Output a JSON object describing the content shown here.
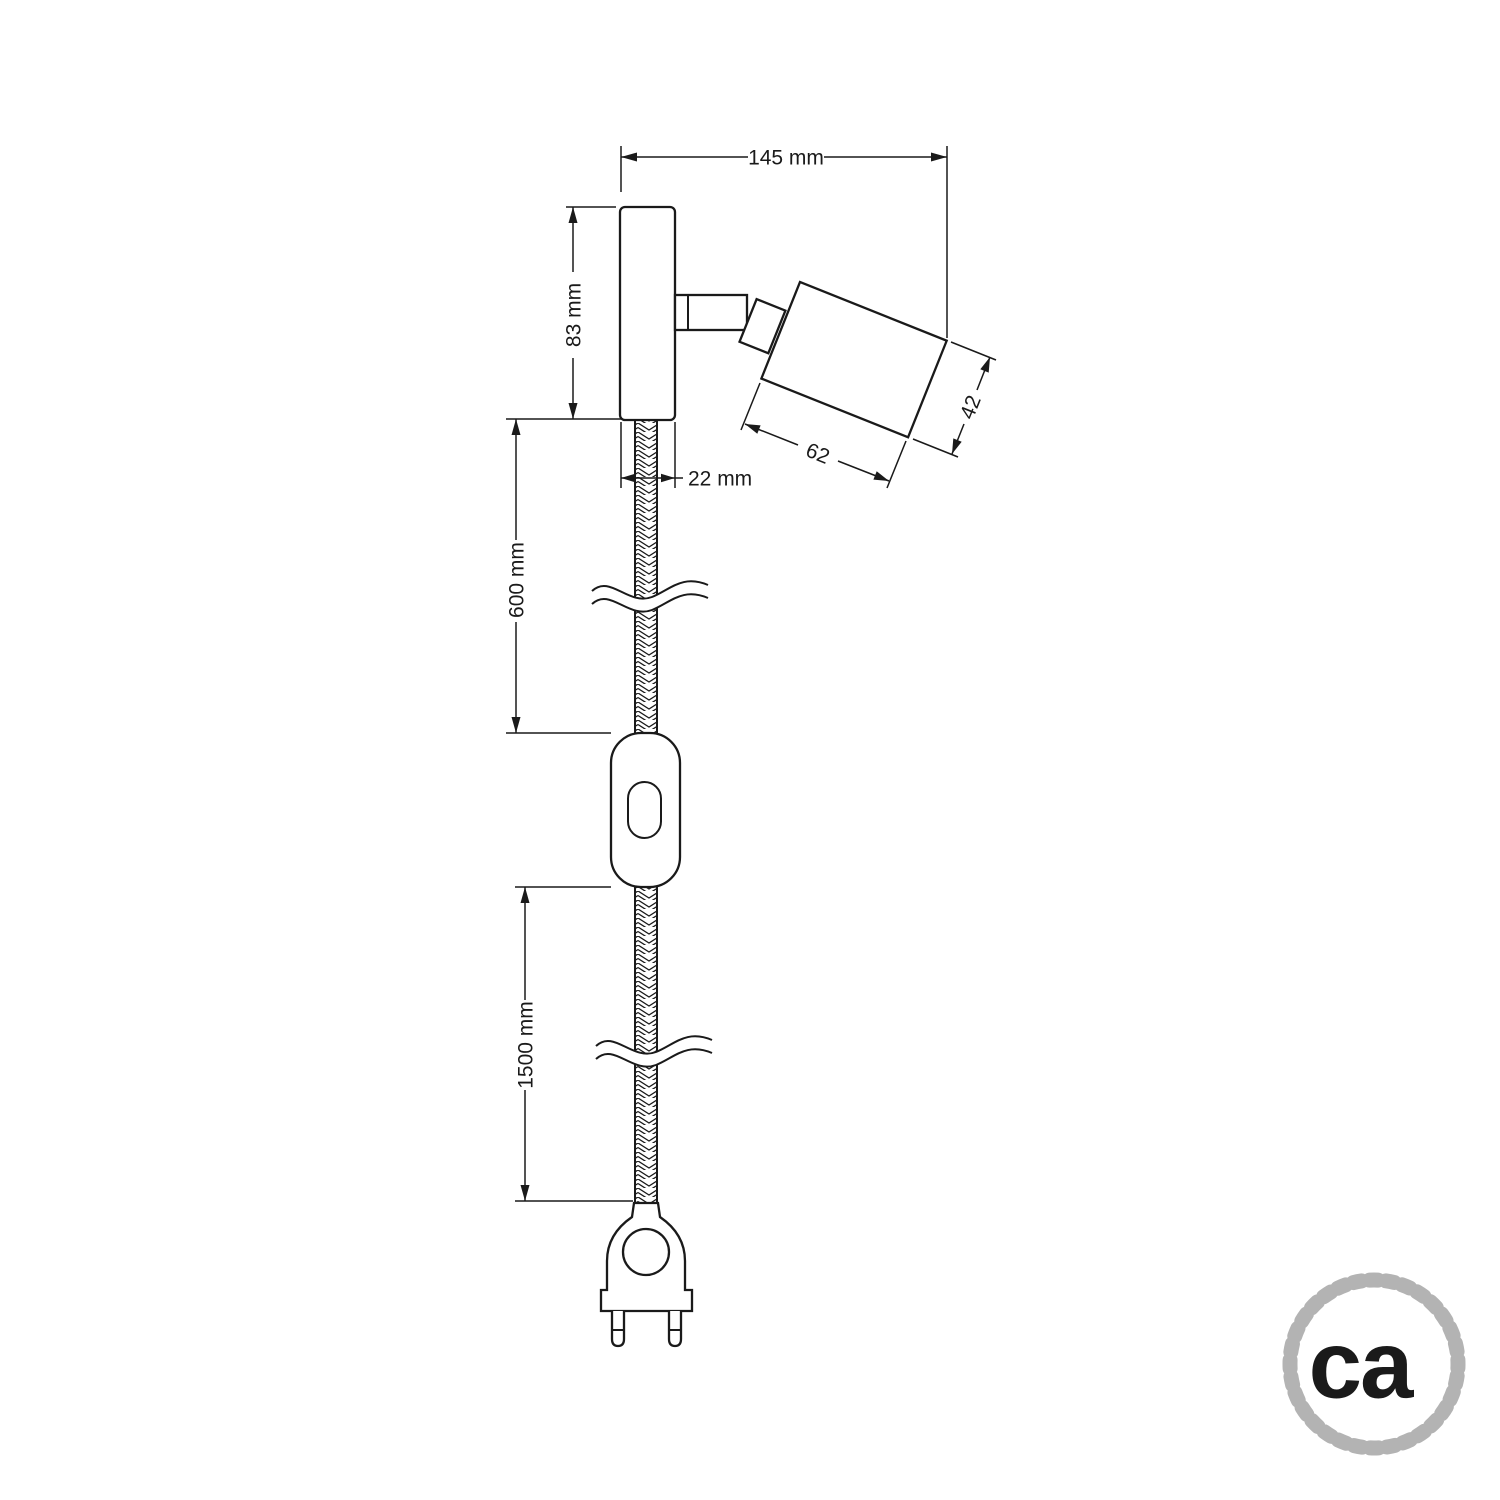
{
  "drawing": {
    "kind": "technical-dimension-drawing",
    "subject": "adjustable wall spotlight with braided cable, inline switch and two-pin plug",
    "colors": {
      "line": "#1a1a1a",
      "logo_gray": "#b3b3b3",
      "background": "#ffffff"
    },
    "dimensions": {
      "overall_width": "145 mm",
      "plate_height": "83 mm",
      "plate_width": "22 mm",
      "upper_cable_length": "600 mm",
      "lower_cable_length": "1500 mm",
      "head_length": "62",
      "head_diameter": "42"
    },
    "logo": {
      "text": "ca",
      "icon": "rope-circle"
    }
  }
}
